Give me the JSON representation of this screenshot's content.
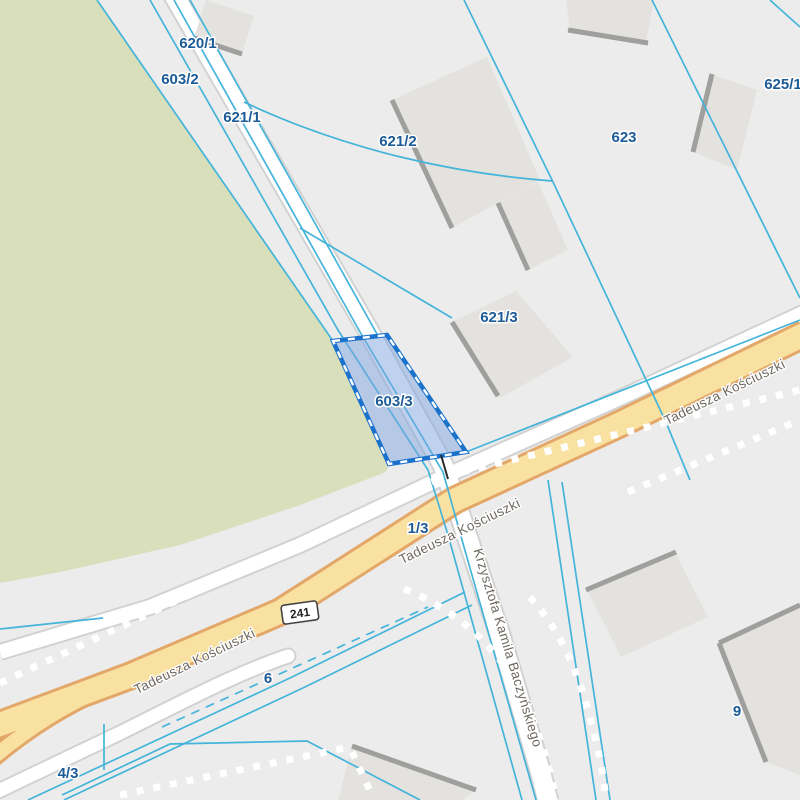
{
  "map": {
    "type": "cadastral-parcel-map",
    "selected_parcel": {
      "id": "603/3",
      "fill_color": "#7ea4e0",
      "border_color": "#1b72cc"
    },
    "parcel_labels": [
      {
        "id": "620/1",
        "text": "620/1",
        "x": 198,
        "y": 44
      },
      {
        "id": "603/2",
        "text": "603/2",
        "x": 180,
        "y": 80
      },
      {
        "id": "621/1",
        "text": "621/1",
        "x": 242,
        "y": 118
      },
      {
        "id": "621/2",
        "text": "621/2",
        "x": 398,
        "y": 142
      },
      {
        "id": "623",
        "text": "623",
        "x": 624,
        "y": 138
      },
      {
        "id": "625/1",
        "text": "625/1",
        "x": 783,
        "y": 85
      },
      {
        "id": "621/3",
        "text": "621/3",
        "x": 499,
        "y": 318
      },
      {
        "id": "603/3",
        "text": "603/3",
        "x": 394,
        "y": 402
      },
      {
        "id": "1/3",
        "text": "1/3",
        "x": 418,
        "y": 529
      },
      {
        "id": "6",
        "text": "6",
        "x": 268,
        "y": 679
      },
      {
        "id": "4/3",
        "text": "4/3",
        "x": 68,
        "y": 774
      },
      {
        "id": "9",
        "text": "9",
        "x": 737,
        "y": 712
      }
    ],
    "street_labels": [
      {
        "text": "Tadeusza Kościuszki",
        "x": 195,
        "y": 662,
        "angle": -26
      },
      {
        "text": "Tadeusza Kościuszki",
        "x": 460,
        "y": 532,
        "angle": -26
      },
      {
        "text": "Tadeusza Kościuszki",
        "x": 725,
        "y": 393,
        "angle": -26
      },
      {
        "text": "Krzysztofa Kamila Baczyńskiego",
        "x": 507,
        "y": 648,
        "angle": 73
      }
    ],
    "route_shield": {
      "text": "241",
      "x": 300,
      "y": 613,
      "angle": -8
    },
    "colors": {
      "background": "#ececec",
      "green_area": "#d8dfba",
      "road_fill": "#ffffff",
      "road_casing": "#d2d2d2",
      "main_road_fill": "#f8e1a1",
      "main_road_casing": "#e3a869",
      "parcel_line": "#44b4da",
      "parcel_label": "#1d5b97",
      "street_label": "#6e6960",
      "building_fill": "#e4e2df",
      "building_shadow": "#9f9f9d",
      "boundary_dots": "#ffffff"
    }
  }
}
